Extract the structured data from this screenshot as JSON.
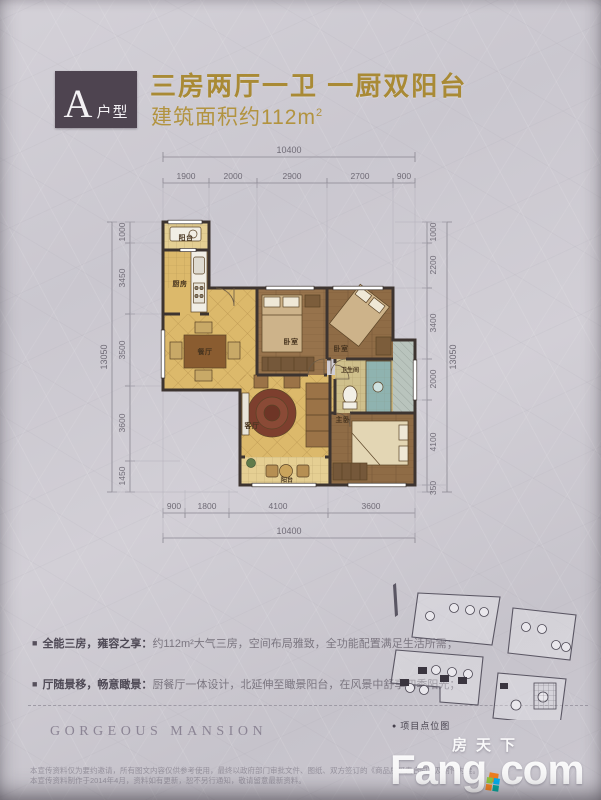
{
  "header": {
    "badge_letter": "A",
    "badge_type": "户型",
    "title": "三房两厅一卫 一厨双阳台",
    "area_text": "建筑面积约112m",
    "area_sup": "2"
  },
  "floorplan": {
    "dims": {
      "top_total": "10400",
      "top_segments": [
        "1900",
        "2000",
        "2900",
        "2700",
        "900"
      ],
      "bottom_total": "10400",
      "bottom_segments": [
        "900",
        "1800",
        "4100",
        "3600"
      ],
      "left_total": "13050",
      "left_segments": [
        "1000",
        "3450",
        "3500",
        "3600",
        "1450"
      ],
      "right_total": "13050",
      "right_segments": [
        "1000",
        "2200",
        "3400",
        "2000",
        "4100",
        "350"
      ]
    },
    "rooms": {
      "balcony_top": "阳台",
      "kitchen": "厨房",
      "dining": "餐厅",
      "bedroom1": "卧室",
      "bedroom2": "卧室",
      "living": "客厅",
      "bath": "卫生间",
      "master": "主卧",
      "balcony_bottom": "阳台"
    }
  },
  "features": [
    {
      "label": "全能三房，雍容之享：",
      "text": "约112m²大气三房，空间布局雅致，全功能配置满足生活所需；"
    },
    {
      "label": "厅随景移，畅意瞰景：",
      "text": "厨餐厅一体设计，北延伸至瞰景阳台，在风景中舒享四季阳光；"
    }
  ],
  "brand": "GORGEOUS MANSION",
  "siteplan_caption": "项目点位图",
  "watermark": {
    "cn": "房天下",
    "en": "Fang",
    "tld": "com"
  },
  "disclaimer": [
    "本宣传资料仅为要约邀请，所有图文内容仅供参考使用，最终以政府部门审批文件、图纸、双方签订的《商品房买卖合同》及附件为准。",
    "本宣传资料制作于2014年4月，资料如有更新，恕不另行通知，敬请留意最新资料。"
  ]
}
